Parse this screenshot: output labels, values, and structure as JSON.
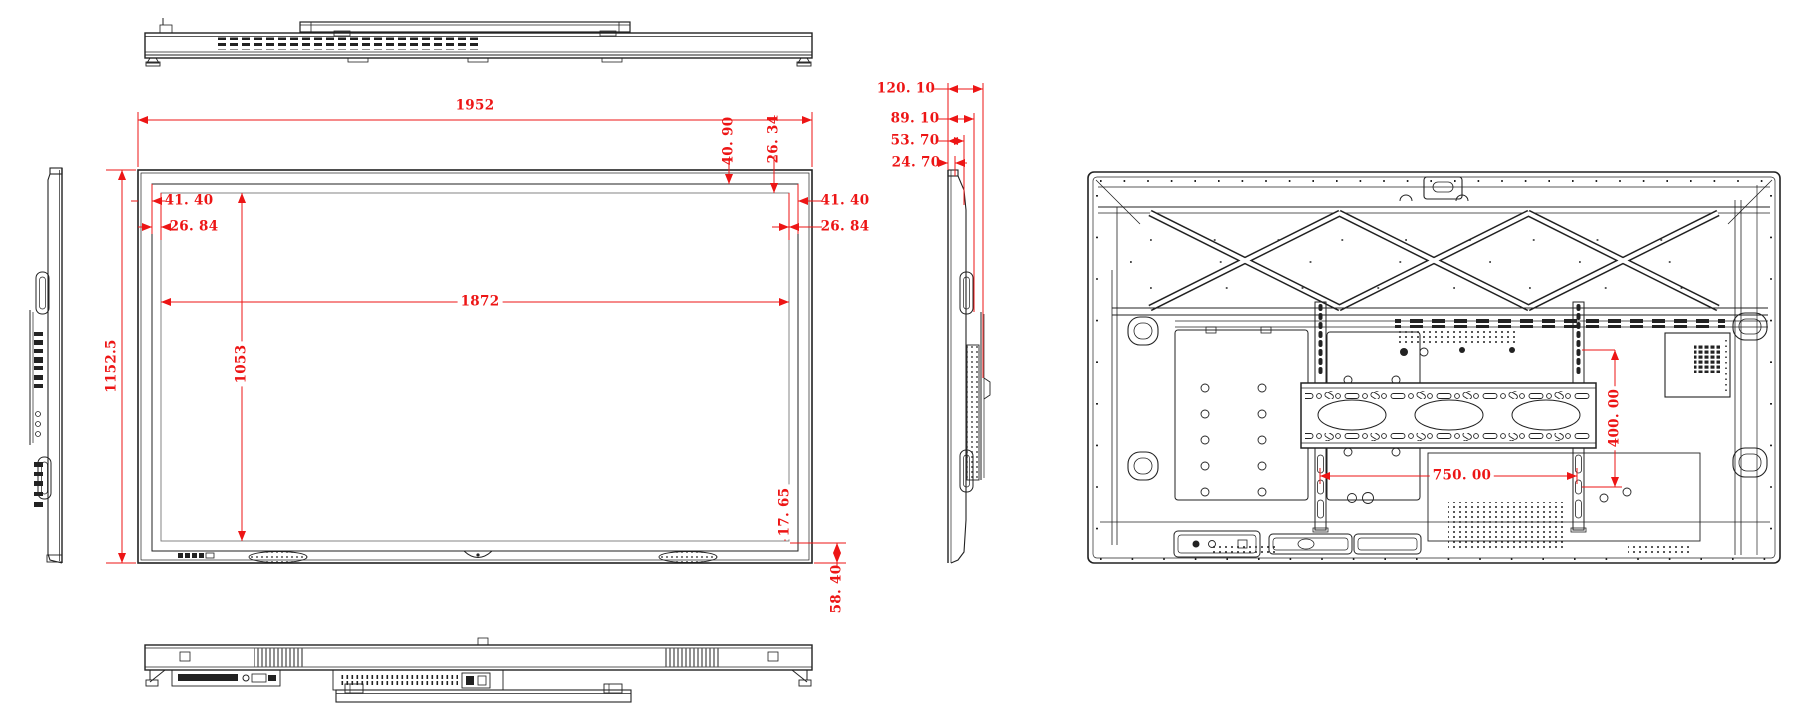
{
  "drawing": {
    "kind": "technical-dimension-drawing",
    "subject": "Large interactive flat panel display - orthographic views",
    "units": "mm",
    "colors": {
      "line": "#222222",
      "dimension": "#ed1515",
      "background": "#ffffff"
    },
    "views": {
      "top": {
        "label": "top-view"
      },
      "left_side": {
        "label": "left-side-view"
      },
      "front": {
        "label": "front-view"
      },
      "right_side": {
        "label": "right-side-view"
      },
      "rear": {
        "label": "rear-view"
      },
      "bottom": {
        "label": "bottom-view"
      }
    },
    "dims": {
      "front": {
        "overall_width": "1952",
        "overall_height": "1152.5",
        "display_width": "1872",
        "display_height": "1053",
        "bezel_left_outer": "41. 40",
        "bezel_left_inner": "26. 84",
        "bezel_right_outer": "41. 40",
        "bezel_right_inner": "26. 84",
        "bezel_top_outer": "40. 90",
        "bezel_top_inner": "26. 34",
        "bezel_bottom_inner": "17. 65",
        "bezel_bottom_outer": "58. 40"
      },
      "side": {
        "depth_overall": "120. 10",
        "depth_back": "89. 10",
        "depth_mid": "53. 70",
        "depth_front": "24. 70"
      },
      "rear": {
        "vesa_width": "750. 00",
        "vesa_height": "400. 00"
      }
    }
  }
}
